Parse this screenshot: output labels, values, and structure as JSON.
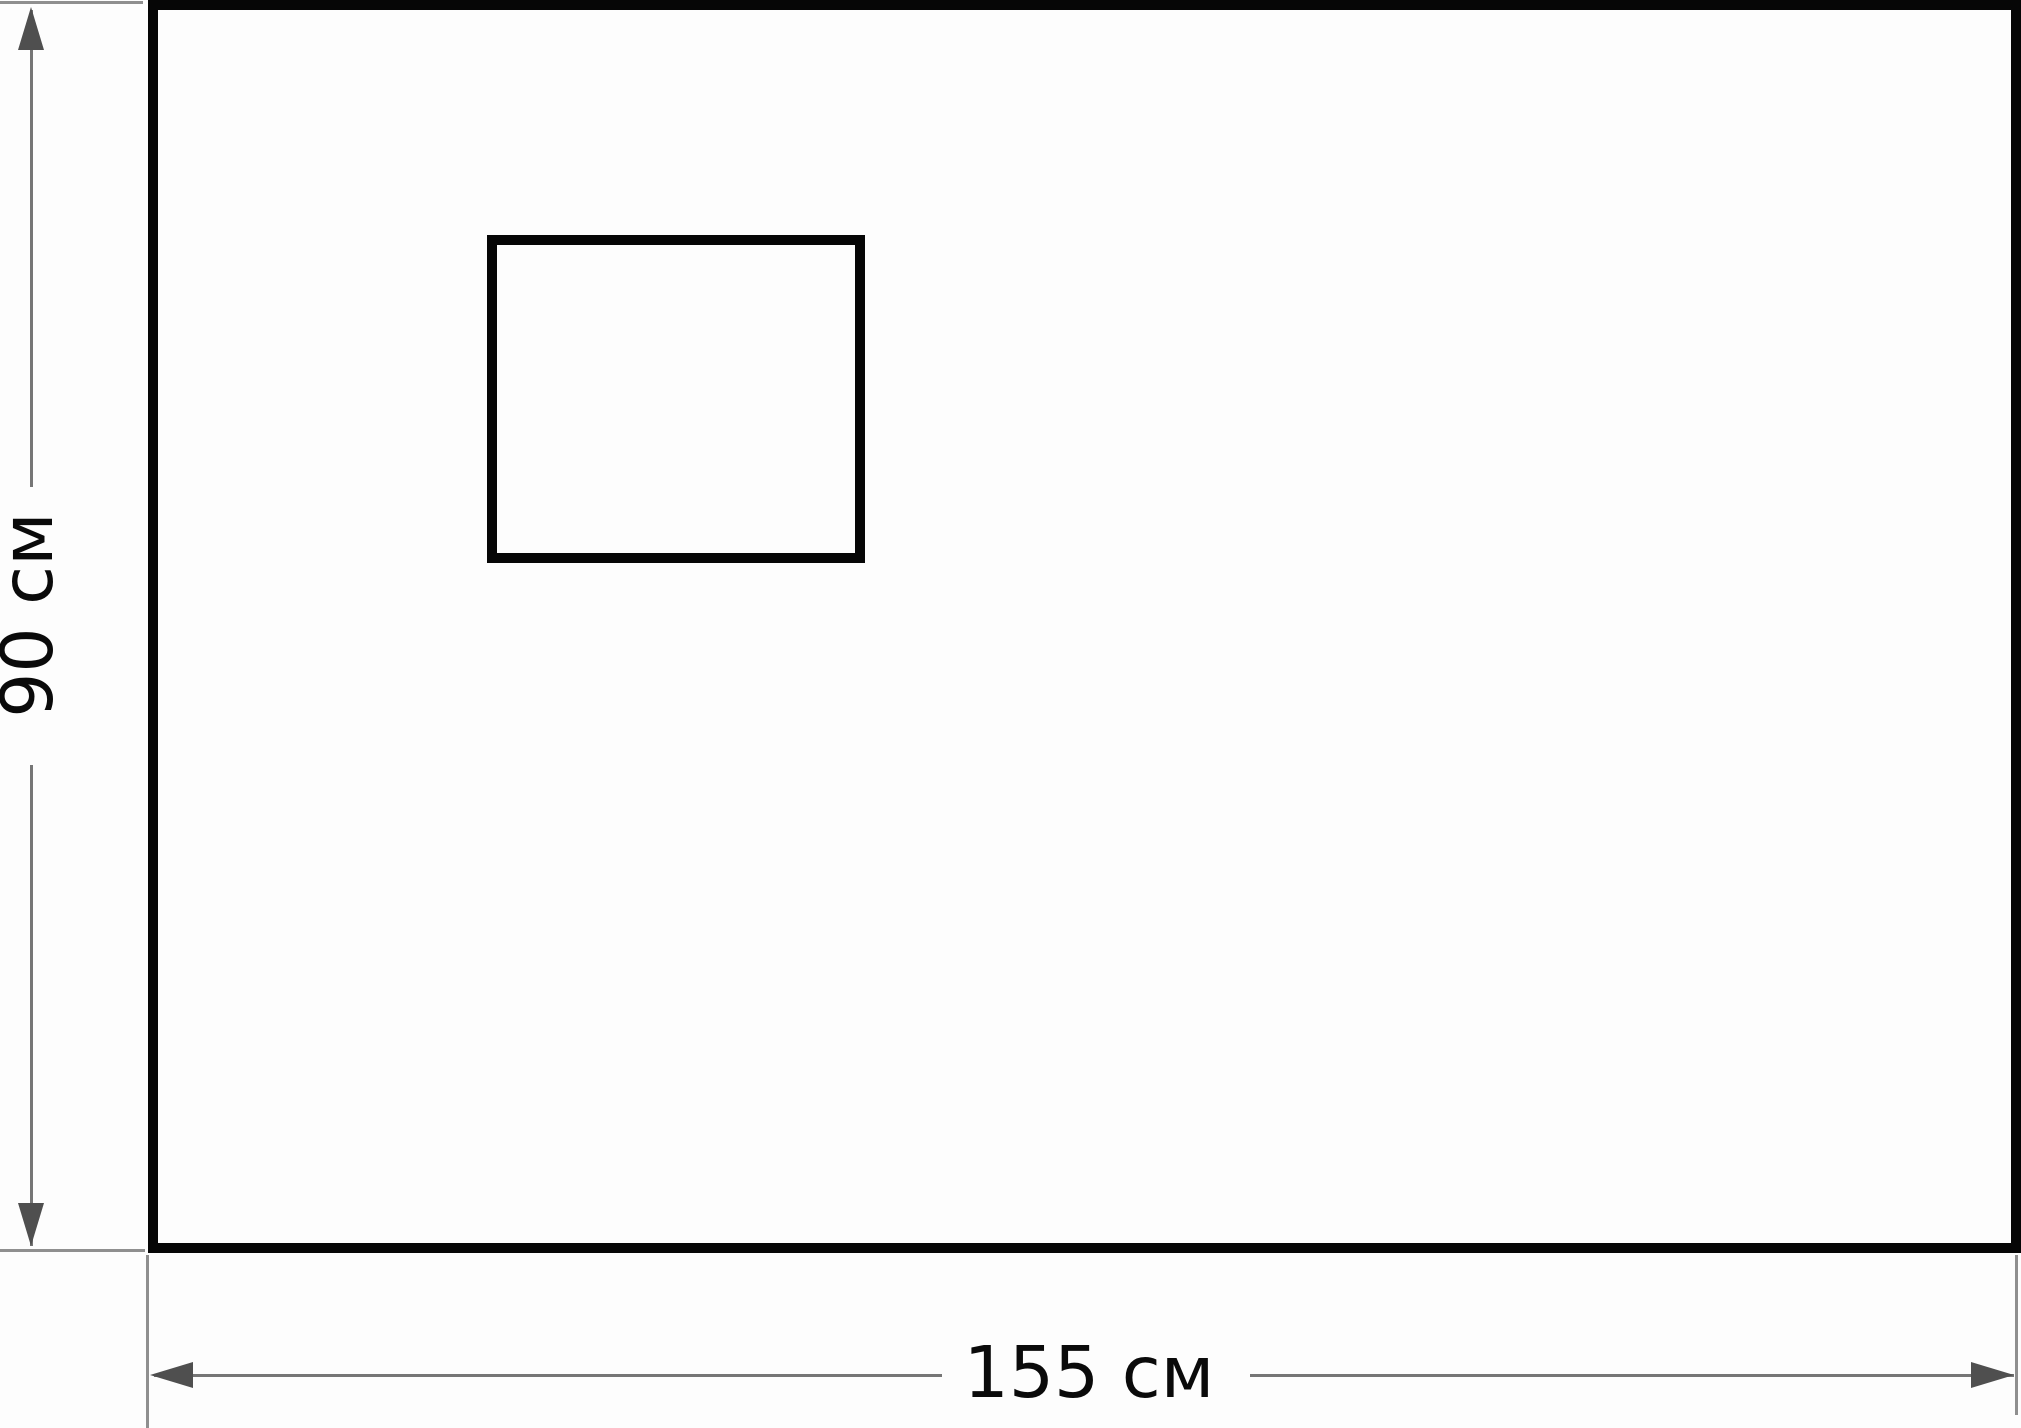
{
  "diagram": {
    "outer_rectangle": {
      "width_label": "155 см",
      "height_label": "90 см",
      "width_value": 155,
      "height_value": 90,
      "unit": "см"
    },
    "inner_rectangle": {
      "position": "upper-left area of outer rectangle",
      "labeled": false
    }
  },
  "colors": {
    "background": "#fdfdfd",
    "rect_border": "#060606",
    "rect_fill": "#fdfdfd",
    "dim_line": "#767676",
    "ext_line": "#8f8f8f",
    "arrow": "#4f4f4f",
    "label_text": "#0a0a0a"
  }
}
